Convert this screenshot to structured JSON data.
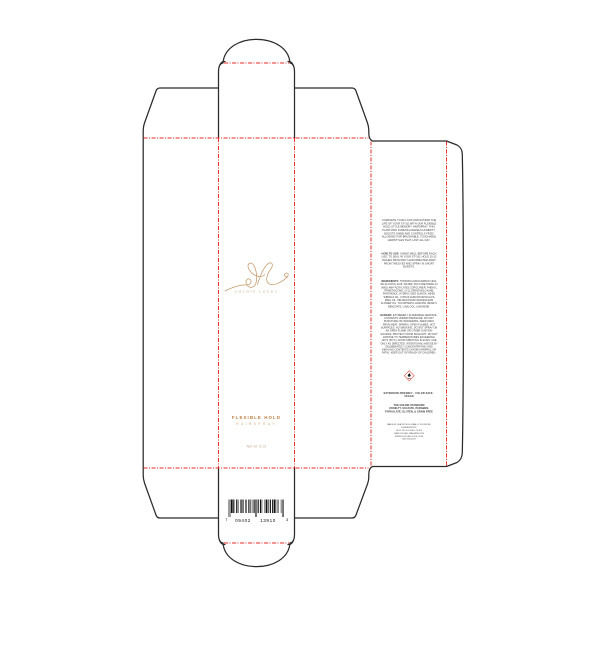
{
  "brand": {
    "logo_monogram": "gl",
    "logo_name": "GOLDIE LOCKS"
  },
  "front_panel": {
    "product_name": "FLEXIBLE HOLD",
    "product_type": "HAIRSPRAY",
    "net_weight": "Net wt. 5 oz"
  },
  "back_panel": {
    "description": "COMPLETE YOUR LOOK AND EXTEND THE LIFE OF YOUR STYLE WITH OUR FLEXIBLE HOLD STYLE MEMORY HAIRSPRAY. THIS PLANT-PRO FORMULA REPELS HUMIDITY, BOOSTS SHINE AND CONTROLS FRIZZ ALLOWING FOR BRUSHABLE, TOUCHABLE HAIRSTYLES THAT LAST ALL DAY.",
    "how_to_use_label": "HOW TO USE: ",
    "how_to_use": "SHAKE WELL BEFORE EACH USE. TO SEAL IN YOUR STYLE, HOLD 10-12 INCHES FROM DRY HAIR DIRECTED AWAY FROM THE EYES AND SPRAY IN SHORT BURSTS.",
    "ingredients_label": "INGREDIENTS: ",
    "ingredients": "HYDROFLUOROCARBON 152A, SD ALCOHOL 40-B, WATER, POLYURETHANE-14 (AND) AMP-ACRYLATES COPOLYMER, PHENYL TRIMETHICONE, CYCLOPENTASILOXANE, PANTHENOL, HYDROLYZED QUINOA, ABIES SIBIRICA OIL, CITRUS AURANTIUM DULCIS PEEL OIL, PELARGONIUM GRAVEOLENS FLOWER OIL, TOCOPHERYL ACETATE, BENZYL BENZOATE, LINALOOL, LIMONENE.",
    "danger_label": "DANGER: ",
    "danger": "EXTREMELY FLAMMABLE AEROSOL. CONTENTS UNDER PRESSURE. DO NOT PUNCTURE OR INCINERATE. KEEP AWAY FROM HEAT, SPARKS, OPEN FLAMES, HOT SURFACES. NO SMOKING. DO NOT SPRAY ON AN OPEN FLAME OR OTHER IGNITION SOURCE. PROTECT FROM SUNLIGHT. DO NOT EXPOSE TO TEMPERATURES EXCEEDING 120°F (50°C). AVOID SPRAYING IN EYES. USE ONLY AS DIRECTED. INTENTIONAL MISUSE BY DELIBERATELY CONCENTRATING AND INHALING CONTENTS CAN BE HARMFUL OR FATAL. KEEP OUT OF REACH OF CHILDREN.",
    "claims": "EXTENSION FRIENDLY · COLOR SAFE · VEGAN",
    "standard_title": "THE GOLDIE STANDARD",
    "standard_line1": "CRUELTY, SULFATE, PARABEN,",
    "standard_line2": "PHTHALATE, GLUTEN, & GRAIN FREE",
    "footer_lines": [
      "MADE IN USA WITH GLOBALLY SOURCED INGREDIENTS",
      "DIST. BY GOLDIE LOCKS",
      "VANCOUVER, WASHINGTON",
      "WWW.GOLDIELOCKS.COM",
      "855-910-4247"
    ]
  },
  "barcode": {
    "left_digit": "7",
    "group1": "09402",
    "group2": "13910",
    "right_digit": "3",
    "full_number": "7 09402 13910 3"
  },
  "colors": {
    "brand_gold": "#c59a6d",
    "accent_gold": "#bf7d42",
    "fold_line_red": "#ed2d24",
    "cut_line_black": "#2b2b2b"
  }
}
